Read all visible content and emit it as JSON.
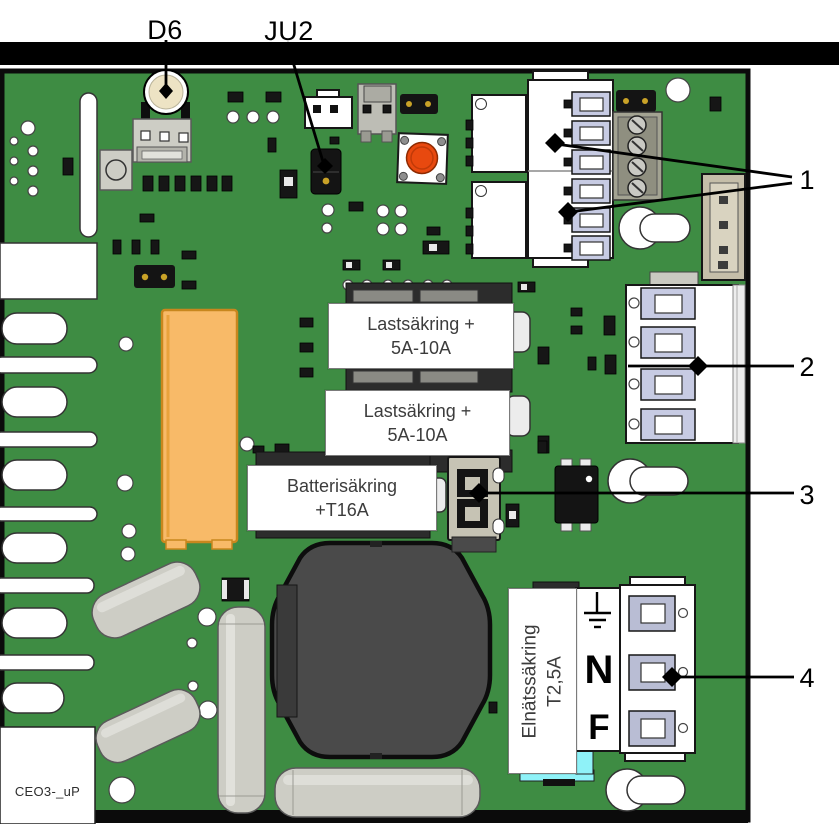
{
  "figure": {
    "type": "annotated PCB diagram",
    "board_id": "CEO3-_uP",
    "component_labels": {
      "d6": "D6",
      "ju2": "JU2"
    },
    "callouts": {
      "1": "1",
      "2": "2",
      "3": "3",
      "4": "4"
    },
    "fuse_labels": {
      "load_fuse_1": {
        "line1": "Lastsäkring +",
        "line2": "5A-10A"
      },
      "load_fuse_2": {
        "line1": "Lastsäkring +",
        "line2": "5A-10A"
      },
      "battery_fuse": {
        "line1": "Batterisäkring",
        "line2": "+T16A"
      },
      "mains_fuse": {
        "line1": "Elnätssäkring",
        "line2": "T2,5A"
      }
    },
    "terminal_labels": {
      "neutral": "N",
      "phase": "F"
    },
    "icons": {
      "earth_ground": "earth-ground-icon"
    },
    "colors": {
      "board-green": "#3E8C43",
      "transformer-orange": "#F8BA68",
      "button-red": "#E8490F",
      "fuse-cyan": "#8FF2F8",
      "clamp-bevel": "#C7CBE3",
      "metal-gray": "#CDCDC5",
      "component-black": "#161616",
      "label-text": "#3C3C3C"
    }
  }
}
